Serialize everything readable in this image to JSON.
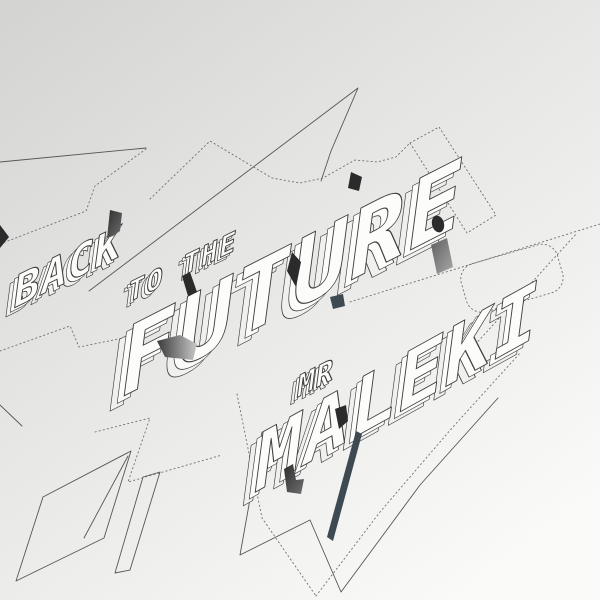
{
  "artwork": {
    "title": {
      "word1": "BACK",
      "word2": "TO THE",
      "word3": "FUTURE"
    },
    "artist": {
      "prefix": "MR",
      "name": "MALEKI"
    },
    "colors": {
      "background_top": "#d5d5d4",
      "background_mid": "#e8e8e6",
      "background_bottom": "#fdfdfc",
      "line": "#565656",
      "dotted_line": "#6e6e6e",
      "letter_face": "#fcfcfb",
      "letter_side": "#f0f0ee",
      "letter_outline": "#3f3f3f",
      "accent_dark": "#2b2b2b",
      "accent_slate": "#3d4a52",
      "accent_gray": "#9a9a9a"
    }
  }
}
